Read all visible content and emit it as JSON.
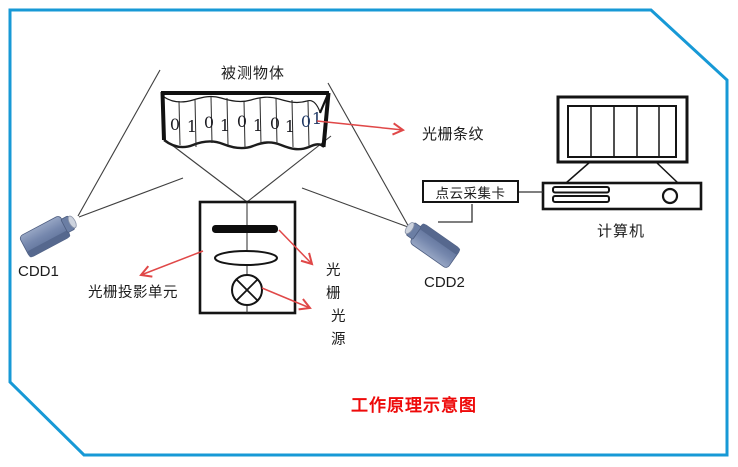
{
  "labels": {
    "measured_object": "被测物体",
    "grating_fringe": "光栅条纹",
    "grating_projection_unit": "光栅投影单元",
    "grating": "光栅",
    "light_source": "光源",
    "camera1": "CDD1",
    "camera2": "CDD2",
    "point_cloud_card": "点云采集卡",
    "computer": "计算机",
    "title": "工作原理示意图"
  },
  "banner": {
    "digits": [
      "0",
      "1",
      "0",
      "1",
      "0",
      "1",
      "0",
      "1",
      "0",
      "1"
    ]
  },
  "colors": {
    "frame_blue": "#1799d6",
    "arrow_red": "#e04848",
    "title_red": "#ee0a0a",
    "line_gray": "#3f3f3f",
    "shape_black": "#141414",
    "camera_blue": "#7587ad"
  }
}
